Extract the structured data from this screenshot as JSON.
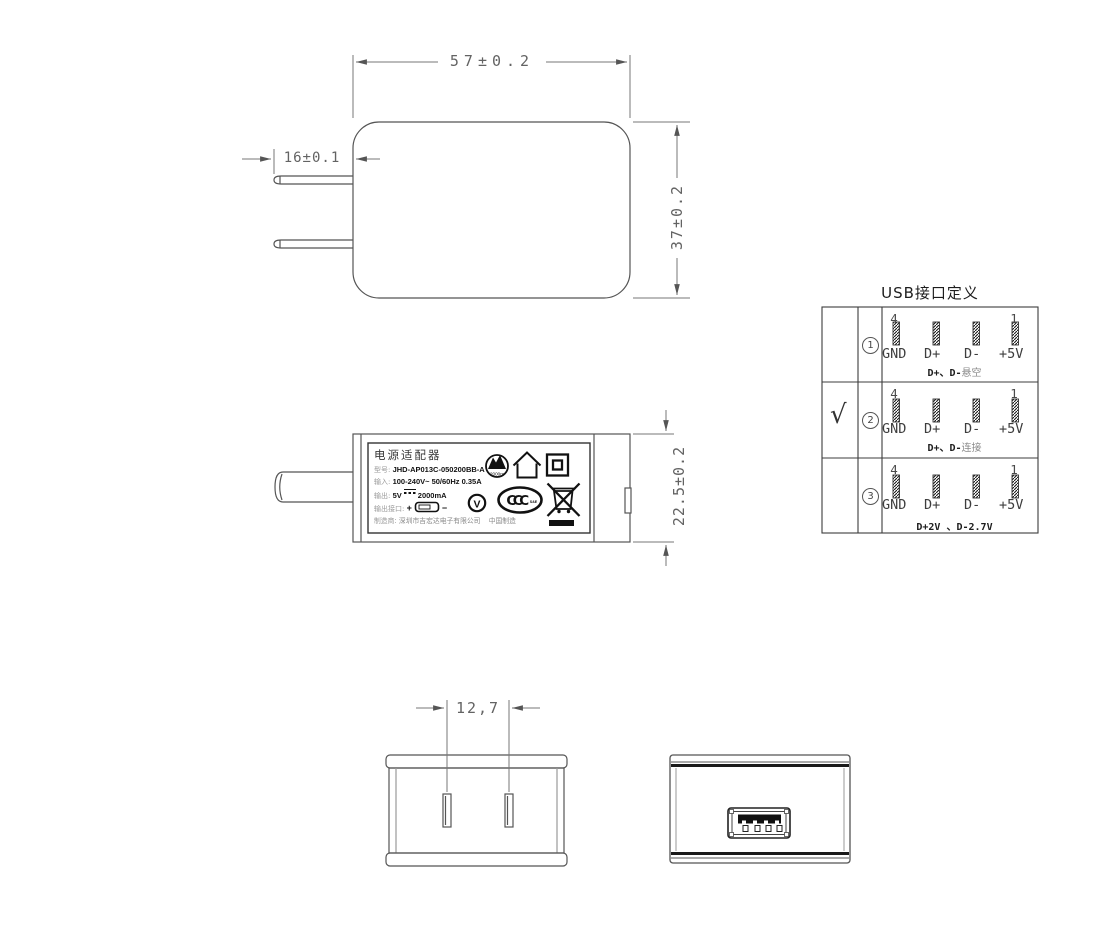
{
  "top_view": {
    "dim_width": "57±0.2",
    "dim_height": "37±0.2",
    "dim_prong_length": "16±0.1"
  },
  "side_view": {
    "dim_height": "22.5±0.2",
    "label": {
      "title": "电源适配器",
      "model_key": "型号:",
      "model_value": "JHD-AP013C-050200BB-A",
      "input_key": "输入:",
      "input_value": "100-240V~  50/60Hz  0.35A",
      "output_key": "输出:",
      "output_voltage": "5V",
      "output_current": "2000mA",
      "output_dc_icon": "dc-symbol",
      "port_key": "输出接口:",
      "port_plus": "+",
      "port_minus": "−",
      "maker_key": "制造商:",
      "maker_company": "深圳市吉宏达电子有限公司",
      "made_in": "中国制造",
      "cert_icons": [
        "altitude-2000m-icon",
        "indoor-use-icon",
        "class-ii-icon",
        "efficiency-v-icon",
        "ccc-icon",
        "weee-icon"
      ],
      "altitude_text": "2000m",
      "efficiency_letter": "V",
      "ccc_text": "CCC",
      "ccc_sub": "S&E"
    }
  },
  "usb_table": {
    "title": "USB接口定义",
    "pin_numbers": {
      "left": "4",
      "right": "1"
    },
    "rows": [
      {
        "selected": "",
        "num": "1",
        "pins": [
          "GND",
          "D+",
          "D-",
          "+5V"
        ],
        "note_bold": "D+、D-",
        "note_plain": "悬空"
      },
      {
        "selected": "√",
        "num": "2",
        "pins": [
          "GND",
          "D+",
          "D-",
          "+5V"
        ],
        "note_bold": "D+、D-",
        "note_plain": "连接"
      },
      {
        "selected": "",
        "num": "3",
        "pins": [
          "GND",
          "D+",
          "D-",
          "+5V"
        ],
        "note_bold": "D+2V 、D-2.7V",
        "note_plain": ""
      }
    ]
  },
  "front_view": {
    "dim_pin_pitch": "12,7"
  },
  "rear_view": {
    "port_icon": "usb-a-port-icon"
  },
  "colors": {
    "outline": "#555555",
    "dimension": "#777777",
    "dim_text": "#636363",
    "table_line": "#3c3c3c",
    "ink": "#111111",
    "background": "#ffffff"
  }
}
